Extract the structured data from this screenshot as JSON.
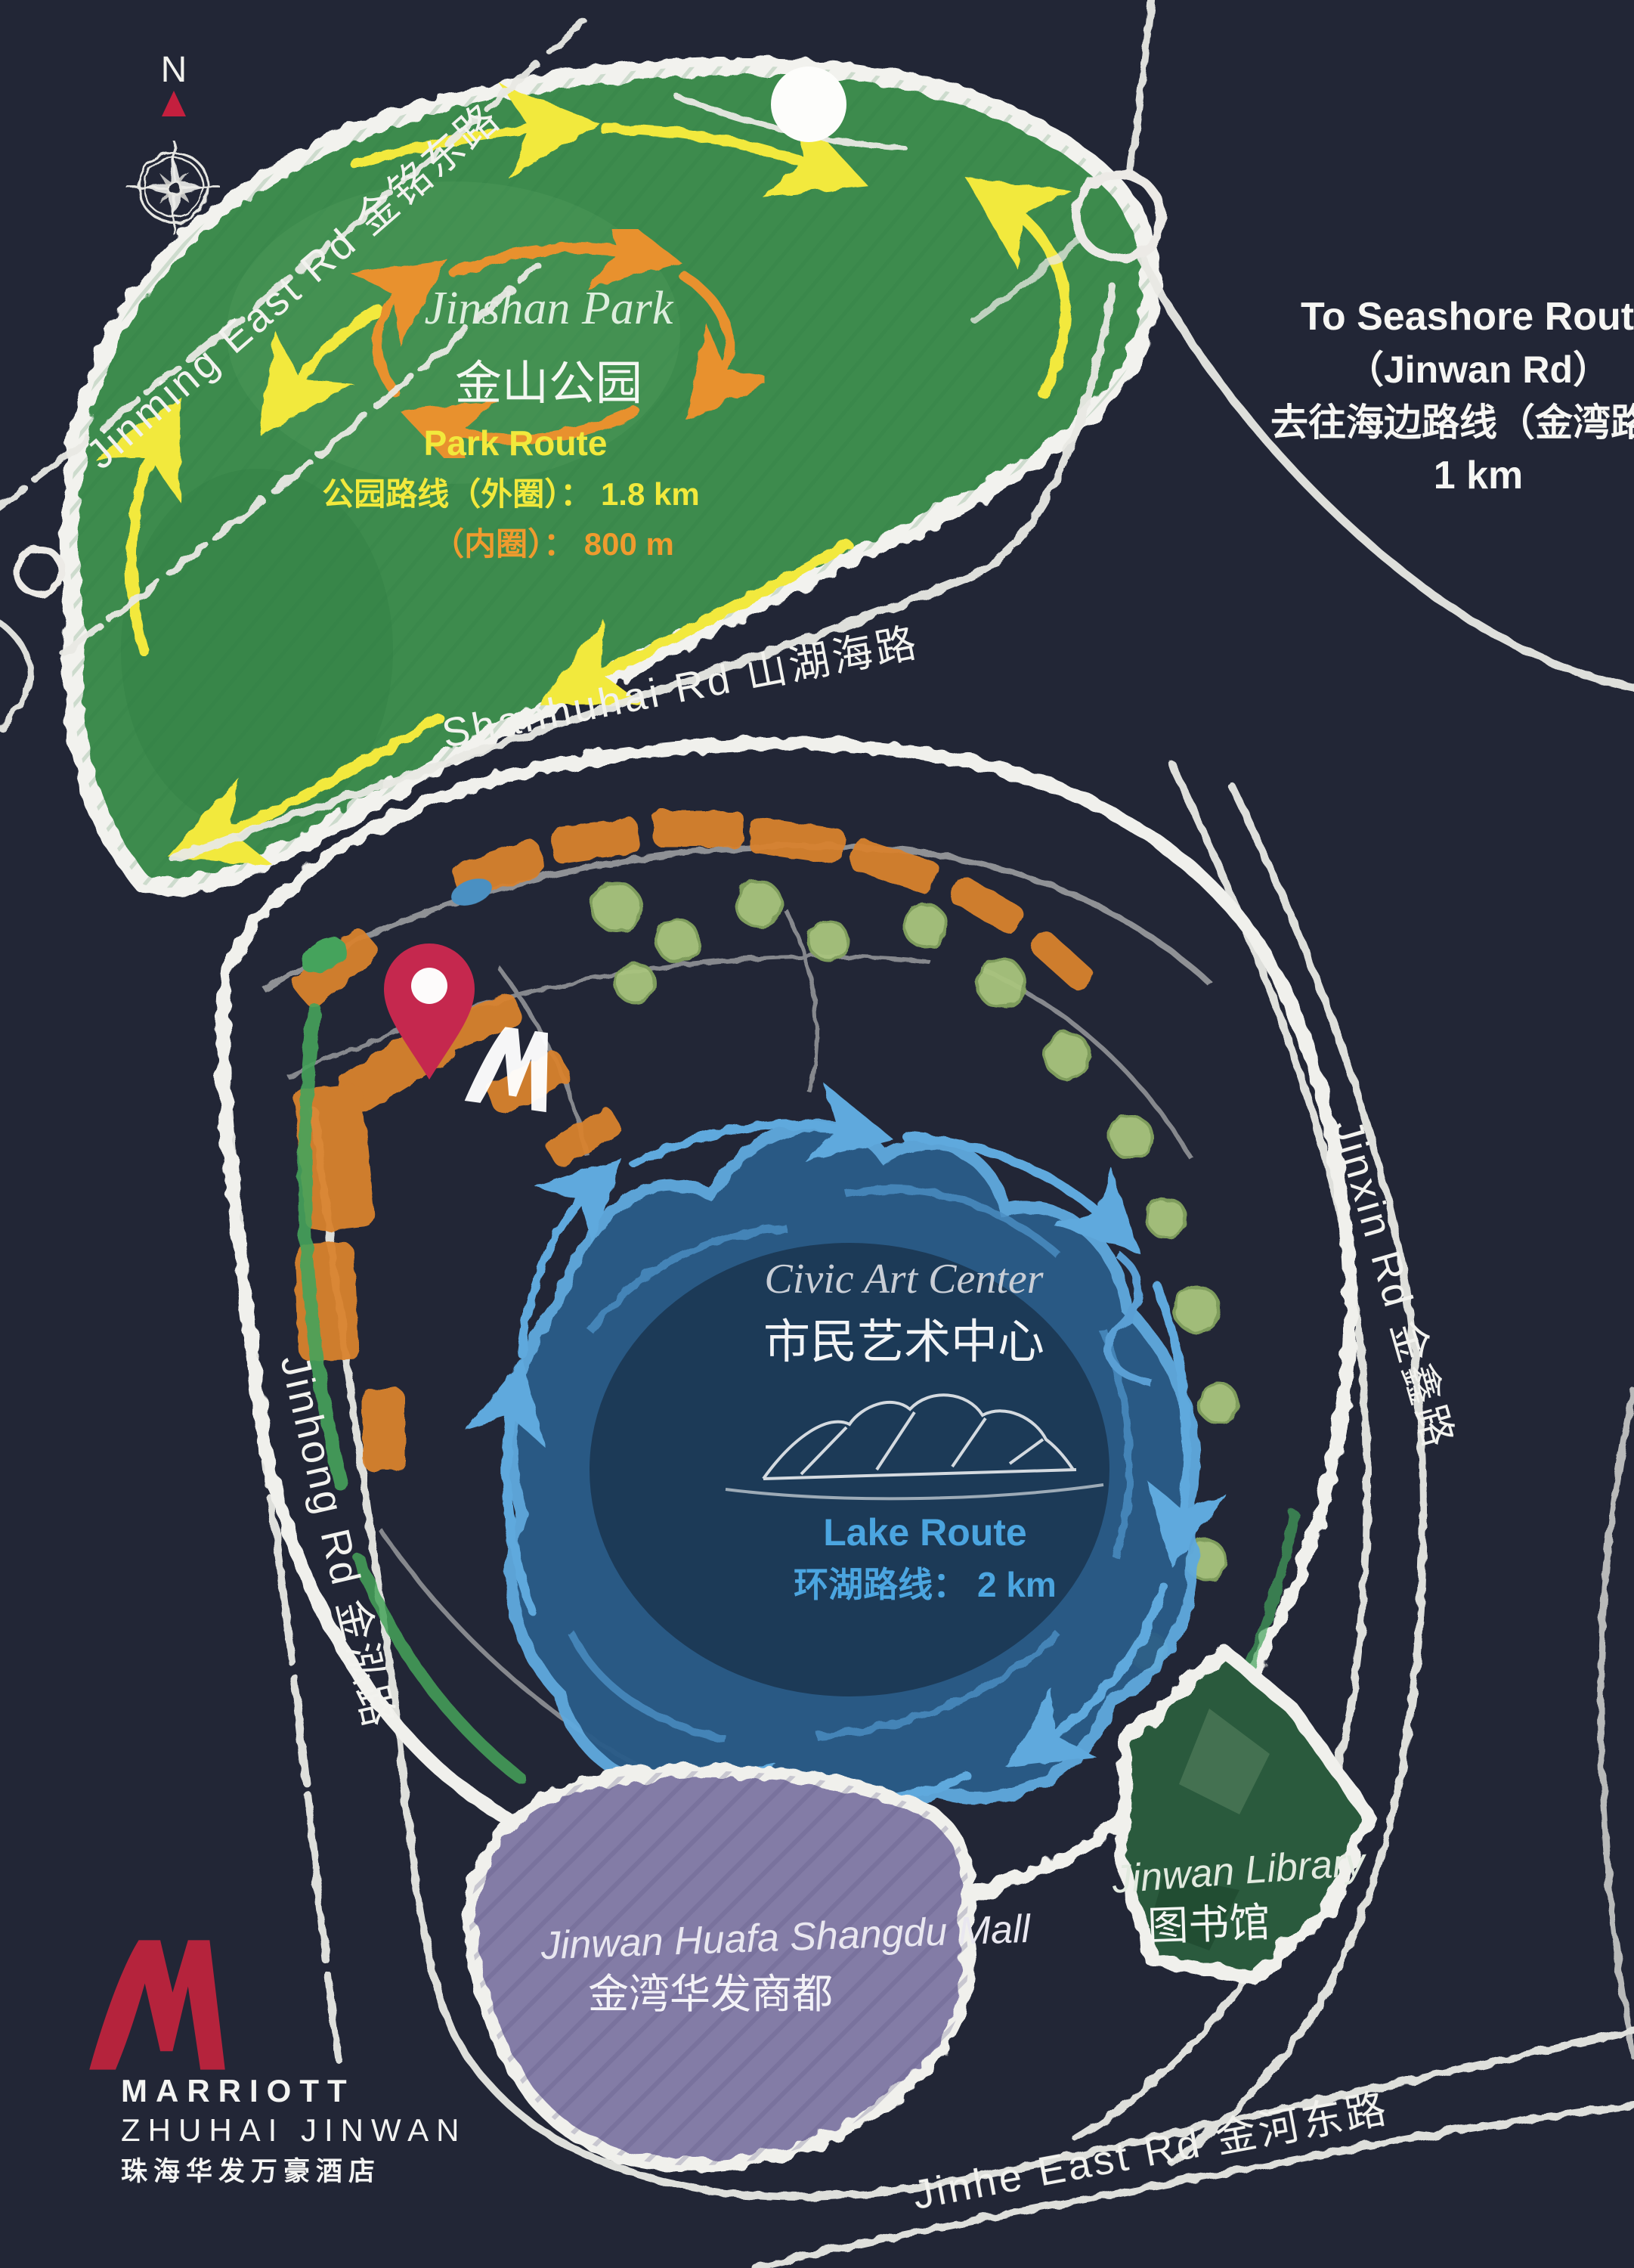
{
  "title": "Marriott Zhuhai Jinwan hand-drawn area map",
  "colors": {
    "background": "#222636",
    "chalk_white": "#f0f0ec",
    "park_green": "#3c8b4d",
    "route_yellow": "#f2e93c",
    "route_orange": "#e8912f",
    "building_orange": "#d9822f",
    "tree_green": "#a9c47e",
    "accent_green": "#45a35b",
    "lake_blue": "#2a5c88",
    "lake_route_blue": "#5fa9dd",
    "lake_text_blue": "#4ba5e0",
    "mall_purple": "#837ba6",
    "library_green": "#2c5a3c",
    "pin_red": "#c5284e",
    "marriott_red": "#b5233c"
  },
  "compass": {
    "north_label": "N"
  },
  "roads": {
    "jinming": "Jinming East Rd 金铭东路",
    "shanhuhai": "Shanhuhai Rd 山湖海路",
    "jinxin": "Jinxin Rd 金鑫路",
    "jinhong": "Jinhong Rd 金泓路",
    "jinhe": "Jinhe East Rd 金河东路"
  },
  "park": {
    "name_en": "Jinshan Park",
    "name_zh": "金山公园",
    "route_title": "Park Route",
    "route_outer": "公园路线（外圈）： 1.8 km",
    "route_inner": "（内圈）： 800 m"
  },
  "seashore": {
    "line1": "To Seashore Route",
    "line2": "（Jinwan Rd）",
    "line3": "去往海边路线（金湾路）",
    "line4": "1 km"
  },
  "civic": {
    "name_en": "Civic Art Center",
    "name_zh": "市民艺术中心"
  },
  "lake": {
    "route_title": "Lake Route",
    "route_info": "环湖路线： 2 km"
  },
  "mall": {
    "name_en": "Jinwan Huafa Shangdu Mall",
    "name_zh": "金湾华发商都"
  },
  "library": {
    "name_en": "Jinwan Library",
    "name_zh": "图书馆"
  },
  "hotel": {
    "brand": "MARRIOTT",
    "location": "ZHUHAI JINWAN",
    "name_zh": "珠海华发万豪酒店"
  }
}
